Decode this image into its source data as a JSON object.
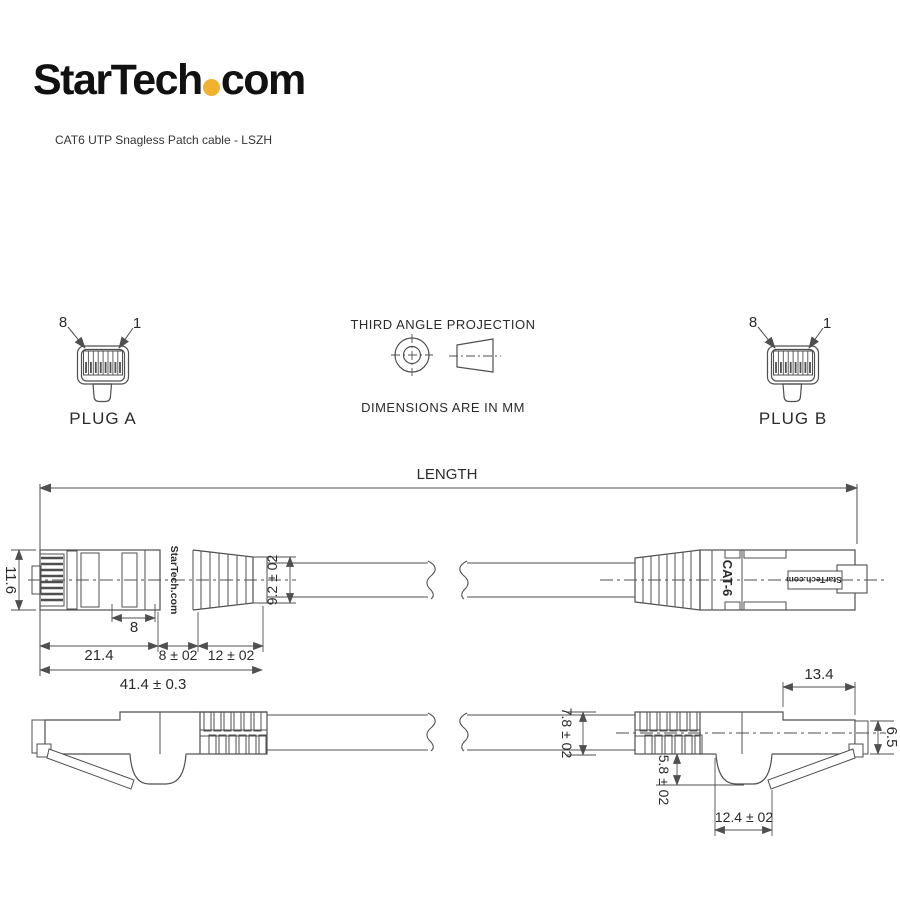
{
  "brand": {
    "name_main": "StarTech",
    "name_tld": "com",
    "dot_color": "#F2B230"
  },
  "subtitle": "CAT6 UTP Snagless Patch cable - LSZH",
  "projection": {
    "title": "THIRD ANGLE PROJECTION",
    "units": "DIMENSIONS ARE IN MM"
  },
  "plug_a": {
    "label": "PLUG A",
    "pin_left": "8",
    "pin_right": "1"
  },
  "plug_b": {
    "label": "PLUG B",
    "pin_left": "8",
    "pin_right": "1"
  },
  "length": {
    "label": "LENGTH"
  },
  "markings": {
    "left_connector_brand": "StarTech.com",
    "right_connector_category": "CAT-6",
    "right_connector_brand": "StarTech.com"
  },
  "dims": {
    "plug_height": "11.6",
    "window_width": "8",
    "body_length": "21.4",
    "mid_length": "8 ± 02",
    "boot_length": "12 ± 02",
    "overall_length": "41.4 ± 0.3",
    "boot_height": "9.2 ± 02",
    "front_length": "13.4",
    "front_height": "6.5",
    "cable_od": "7.8 ± 02",
    "latch_depth": "5.8 ± 02",
    "hood_width": "12.4 ± 02"
  },
  "colors": {
    "line": "#4f4f4f",
    "text": "#2b2b2b"
  }
}
